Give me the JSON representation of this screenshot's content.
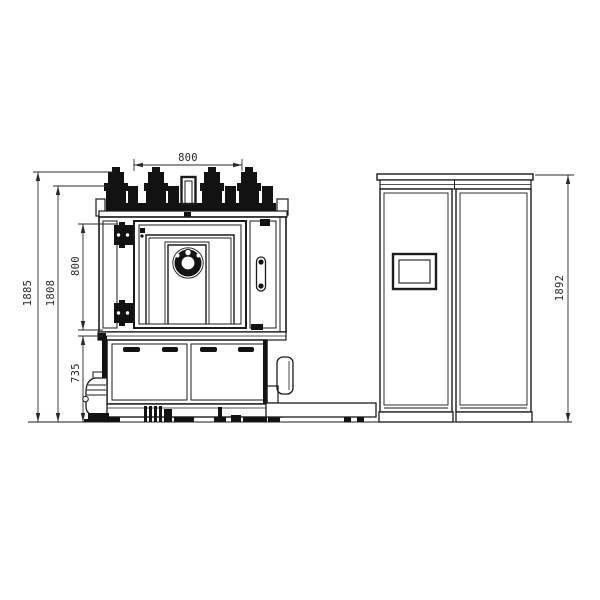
{
  "drawing": {
    "type": "engineering-front-view",
    "subject": "vacuum coating machine with electrical control cabinet",
    "background": "#ffffff",
    "line_color": "#1b1b1b",
    "dimensions": {
      "chamber_width_top": "800",
      "overall_height": "1885",
      "body_height": "1808",
      "door_height": "800",
      "base_height": "735",
      "cabinet_height": "1892"
    }
  }
}
